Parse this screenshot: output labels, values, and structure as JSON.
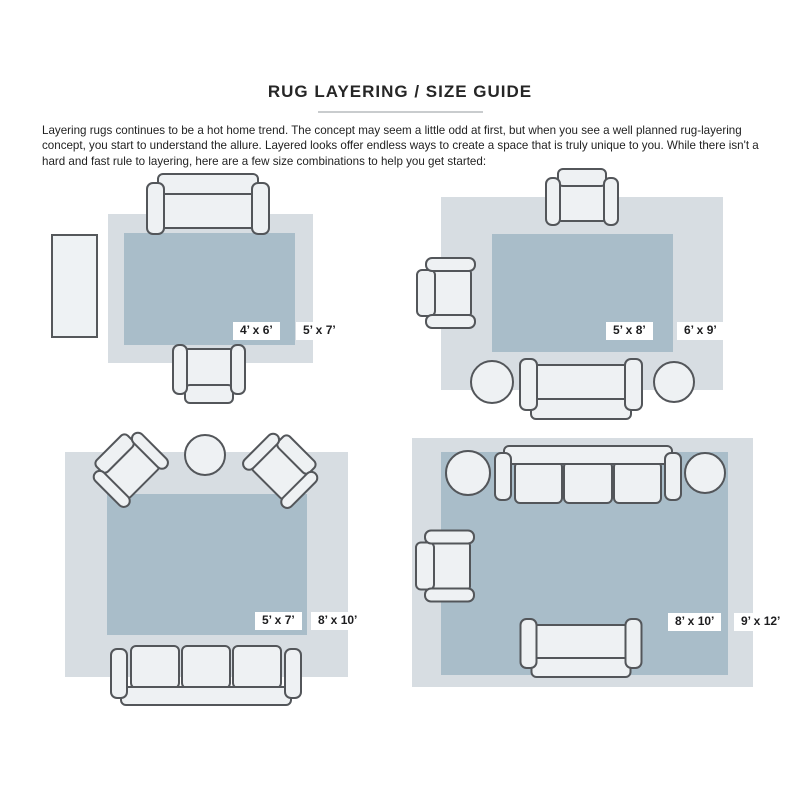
{
  "page": {
    "title": "RUG LAYERING / SIZE GUIDE",
    "intro": "Layering rugs continues to be a hot home trend. The concept may seem a little odd at first, but when you see a well planned rug-layering concept, you start to understand the allure. Layered looks offer endless ways to create a space that is truly unique to you. While there isn't a hard and fast rule to layering, here are a few size combinations to help you get started:"
  },
  "colors": {
    "base_rug": "#d7dde2",
    "layered_rug": "#a9bdc9",
    "furniture_fill": "#eef1f3",
    "furniture_outline": "#53565a",
    "label_bg": "#ffffff",
    "label_text": "#1d1d1f"
  },
  "layouts": [
    {
      "position": "top-left",
      "top_rug_label": "4’ x 6’",
      "base_rug_label": "5’ x 7’"
    },
    {
      "position": "top-right",
      "top_rug_label": "5’ x 8’",
      "base_rug_label": "6’ x 9’"
    },
    {
      "position": "bottom-left",
      "top_rug_label": "5’ x 7’",
      "base_rug_label": "8’ x 10’"
    },
    {
      "position": "bottom-right",
      "top_rug_label": "8’ x 10’",
      "base_rug_label": "9’ x 12’"
    }
  ]
}
